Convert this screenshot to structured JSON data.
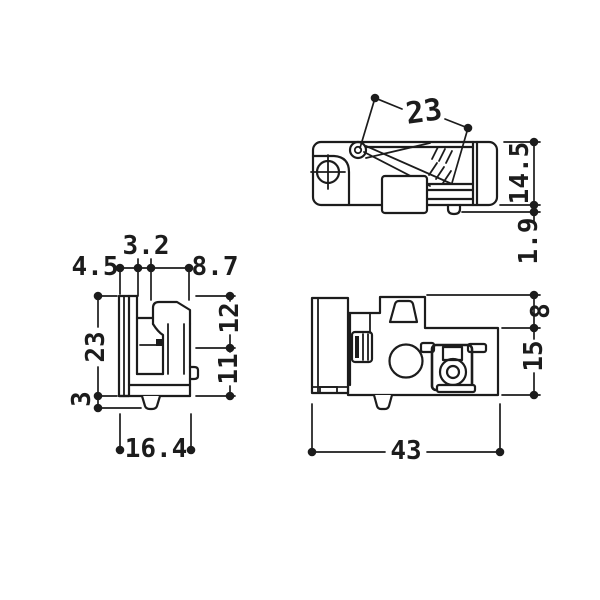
{
  "colors": {
    "background": "#ffffff",
    "line": "#1c1c1c"
  },
  "views": {
    "top": {
      "dims": {
        "spring_length": "23",
        "body_depth": "14.5",
        "pin_protrusion": "1.9"
      }
    },
    "side": {
      "dims": {
        "plate_offset": "4.5",
        "slot_width": "3.2",
        "hook_width": "8.7",
        "height": "23",
        "base_thickness": "3",
        "overall_width": "16.4",
        "upper_height": "12",
        "lower_height": "11"
      }
    },
    "front": {
      "dims": {
        "top_step_height": "8",
        "body_height": "15",
        "overall_width": "43"
      }
    }
  }
}
